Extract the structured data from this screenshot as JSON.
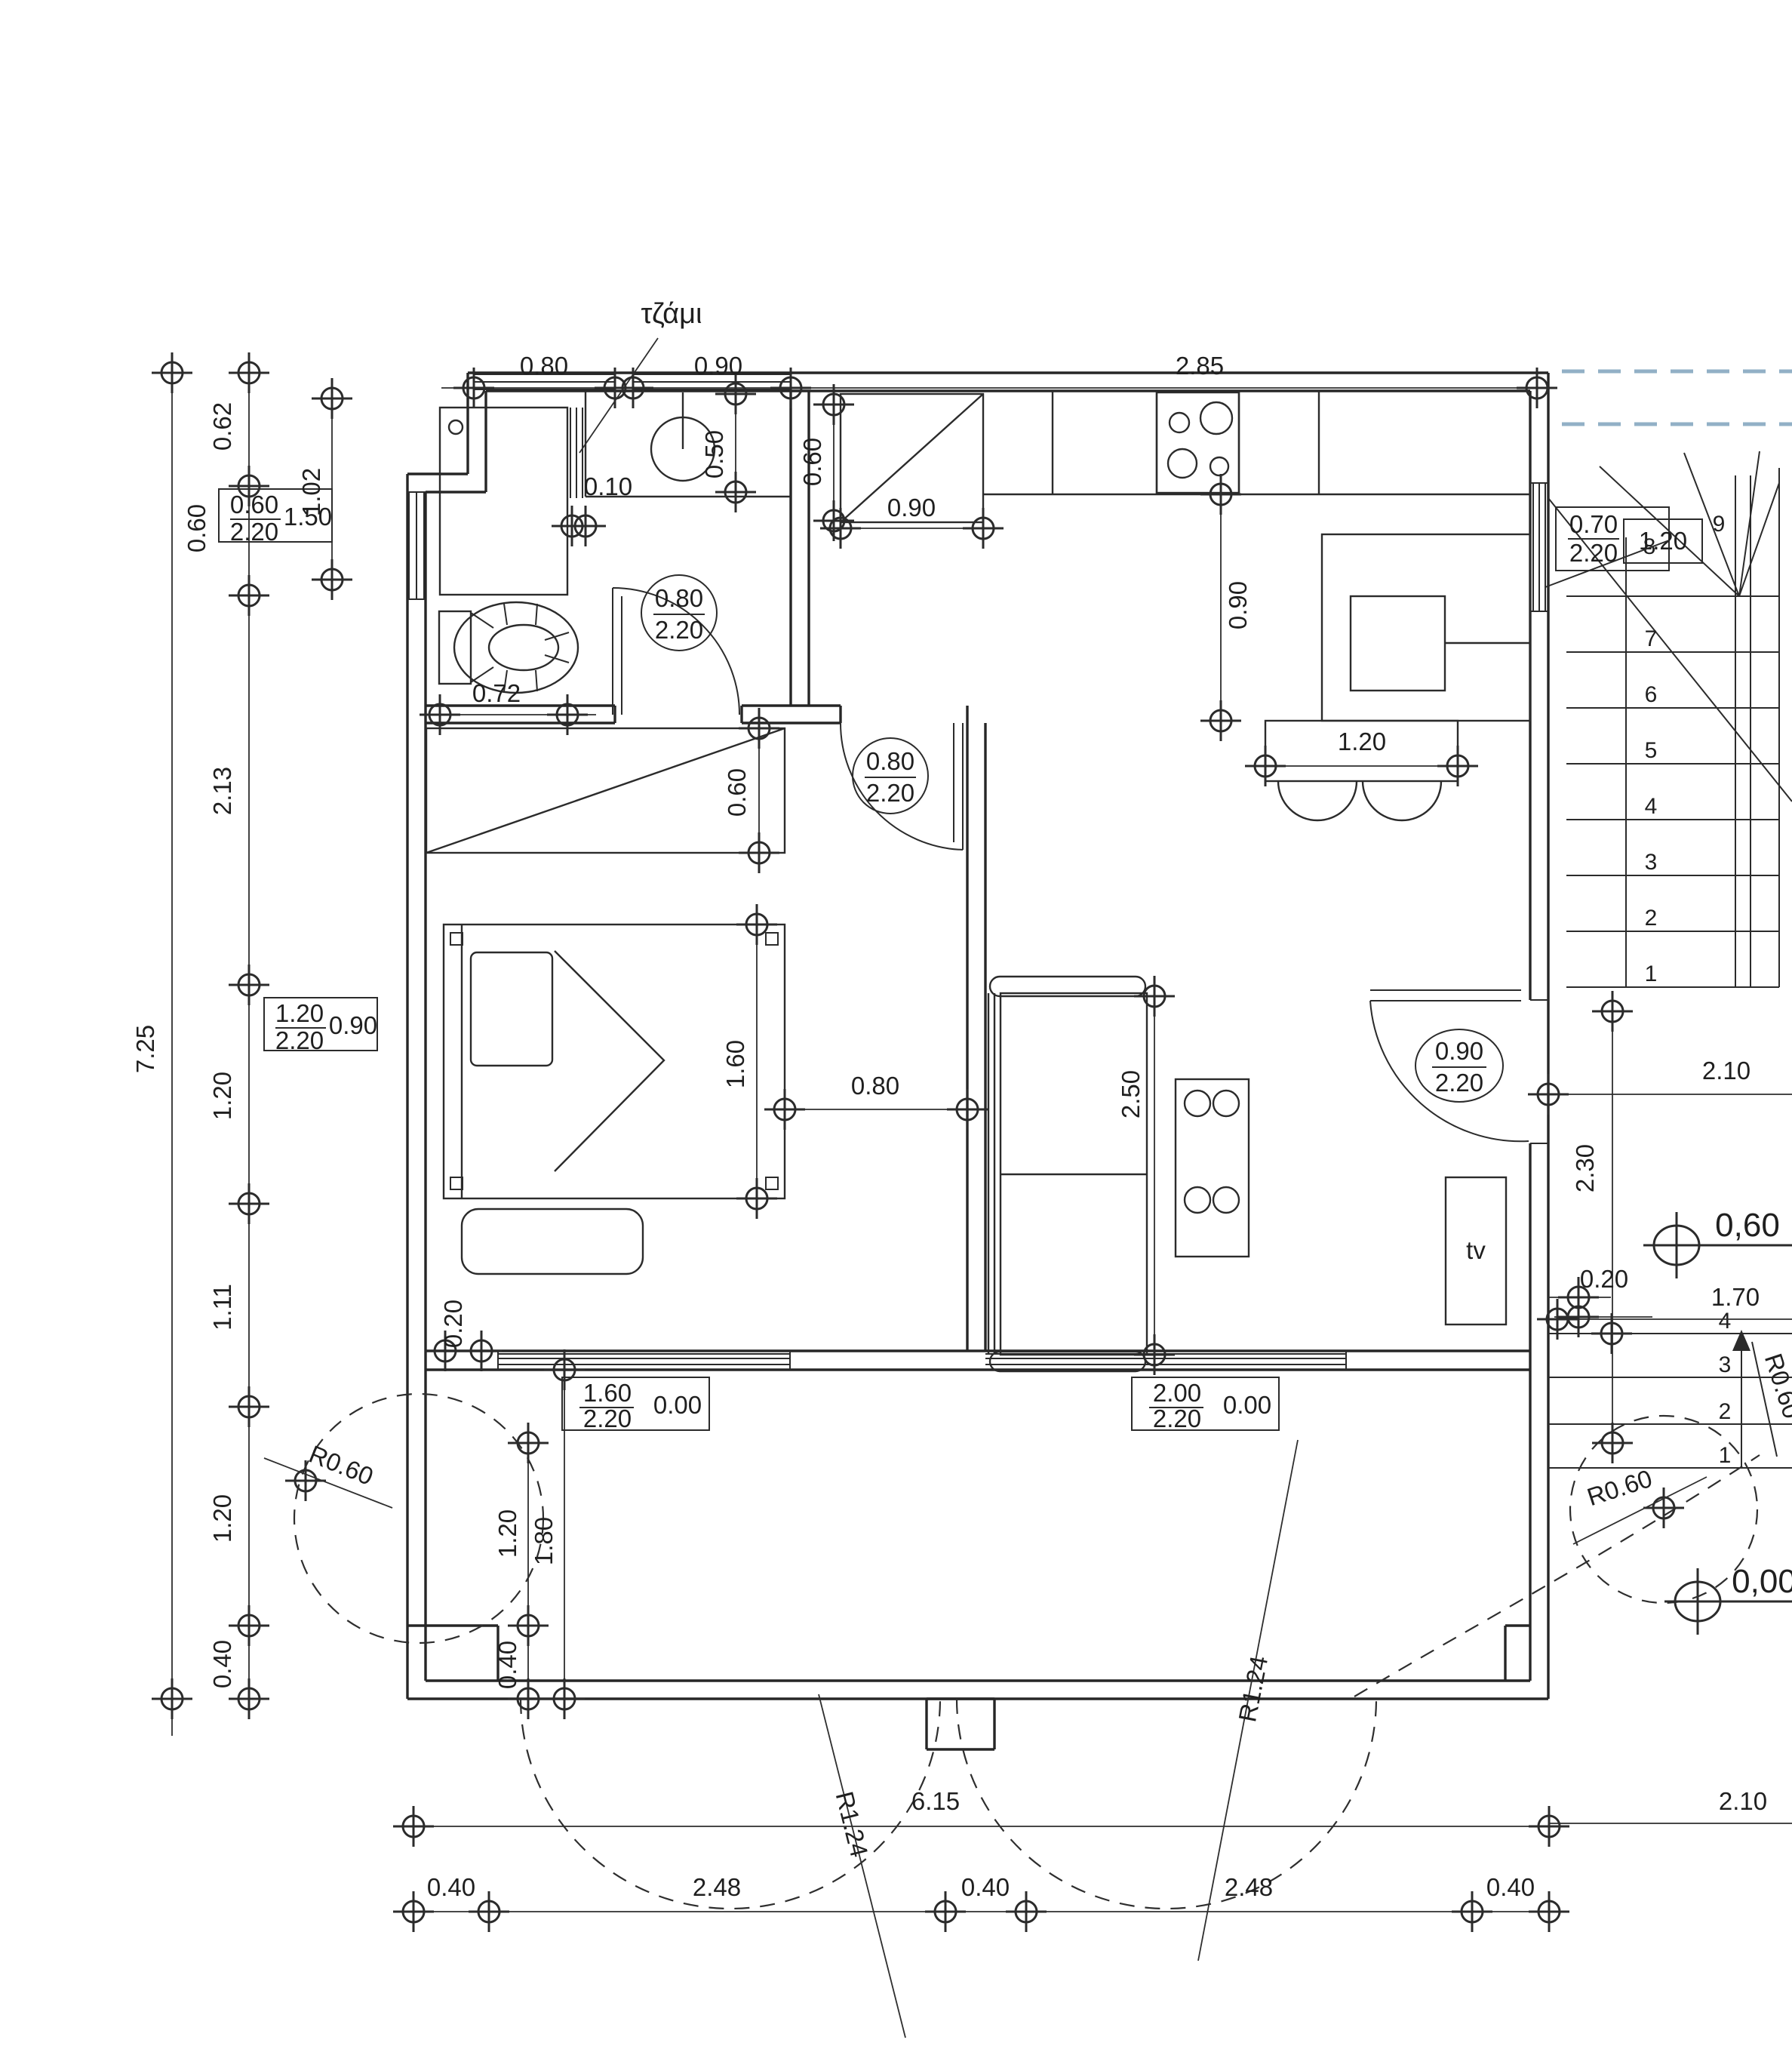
{
  "drawing": {
    "kind": "architectural floor plan",
    "glass_note": "τζάμι",
    "tv_label": "tv"
  },
  "labels": {
    "tzami": "τζάμι",
    "tv": "tv",
    "dims": {
      "top080": "0.80",
      "top090": "0.90",
      "top285": "2.85",
      "l062": "0.62",
      "l060": "0.60",
      "l213": "2.13",
      "l120a": "1.20",
      "l111": "1.11",
      "l120b": "1.20",
      "l040": "0.40",
      "l725": "7.25",
      "v102": "1.02",
      "v050": "0.50",
      "v060p": "0.60",
      "h090p": "0.90",
      "h010": "0.10",
      "h072": "0.72",
      "w060": "0.60",
      "bed160": "1.60",
      "bed080": "0.80",
      "sofa250": "2.50",
      "k090": "0.90",
      "bar120": "1.20",
      "r230": "2.30",
      "r210m": "2.10",
      "r170": "1.70",
      "r020tv": "0.20",
      "r020bed": "0.20",
      "v120": "1.20",
      "v180": "1.80",
      "v040": "0.40",
      "b615": "6.15",
      "b040a": "0.40",
      "b248a": "2.48",
      "b040b": "0.40",
      "b248b": "2.48",
      "b040c": "0.40",
      "b210": "2.10"
    },
    "tags": {
      "win_left": {
        "w": "0.60",
        "h": "2.20",
        "sill": "1.50"
      },
      "win_bed": {
        "w": "1.20",
        "h": "2.20",
        "sill": "0.90"
      },
      "door_bath": {
        "w": "0.80",
        "h": "2.20"
      },
      "door_bed": {
        "w": "0.80",
        "h": "2.20"
      },
      "door_entry": {
        "w": "0.90",
        "h": "2.20"
      },
      "door_stair": {
        "w": "0.70",
        "h": "2.20"
      },
      "stair_width": "1.20",
      "win_ver1": {
        "w": "1.60",
        "h": "2.20",
        "sill": "0.00"
      },
      "win_ver2": {
        "w": "2.00",
        "h": "2.20",
        "sill": "0.00"
      }
    },
    "radii": {
      "r060_left": "R0.60",
      "r060_right": "R0.60",
      "r060_stair": "R0.60",
      "r124_left": "R1.24",
      "r124_right": "R1.24"
    },
    "levels": {
      "upper": "0,60",
      "ground": "0,00"
    },
    "stairs": {
      "main": [
        "1",
        "2",
        "3",
        "4",
        "5",
        "6",
        "7"
      ],
      "winders": [
        "8",
        "9"
      ],
      "entry": [
        "1",
        "2",
        "3",
        "4"
      ]
    }
  }
}
